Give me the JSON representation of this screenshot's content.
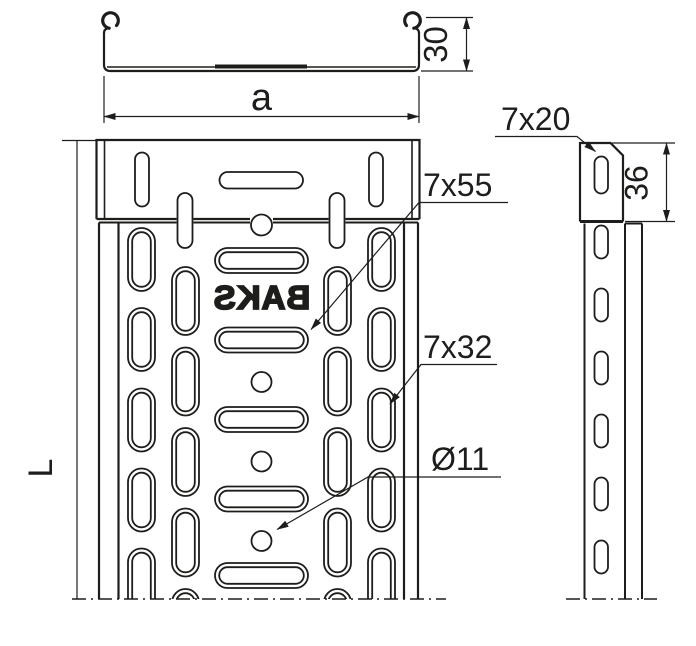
{
  "colors": {
    "line": "#1d1d1b",
    "background": "#ffffff"
  },
  "cross_section": {
    "width_label": "a",
    "height_label": "30"
  },
  "plan_view": {
    "length_label": "L",
    "brand_text": "BAKS",
    "long_slot_label": "7x55",
    "side_slot_label": "7x32",
    "hole_label": "Ø11"
  },
  "side_view": {
    "end_slot_label": "7x20",
    "connector_length_label": "36"
  }
}
